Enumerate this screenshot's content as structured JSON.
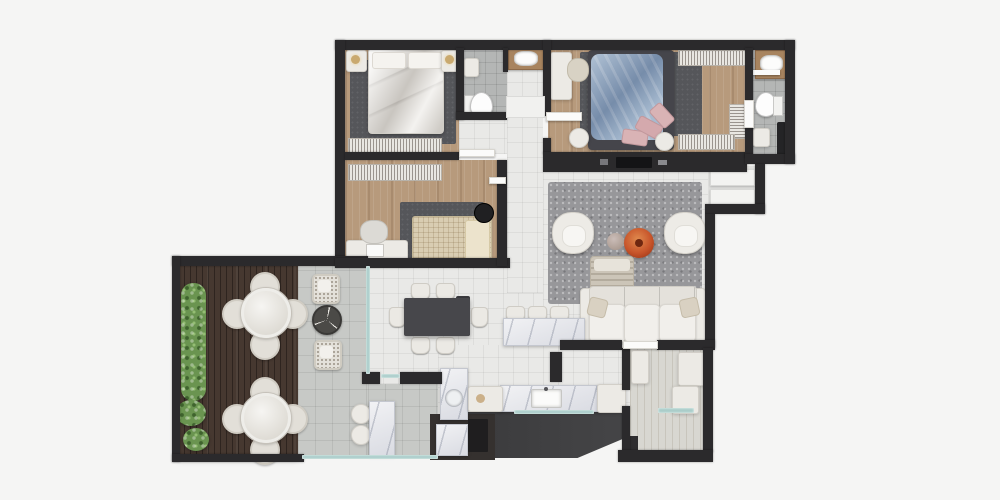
{
  "scene": {
    "type": "apartment-floor-plan-3d-render",
    "view": "top-down",
    "background": "#f5f5f4"
  },
  "palette": {
    "bg": "#f5f5f4",
    "wall": "#2b2a2c",
    "wood": "#b79a7c",
    "wood2": "#a8845f",
    "deck": "#463830",
    "tileLight": "#e9e9e7",
    "tileTerrace": "#c7c9c6",
    "tileBath": "#b4b6b5",
    "laundryFloor": "#d8d7d1",
    "rugLiving": "#97979a",
    "rugDark": "#55565a",
    "white": "#eceae5",
    "marble": "#e3e4e9",
    "glass": "#a9cdc9",
    "accentOrange": "#c85a32",
    "blue": "#8ea7c2",
    "pink": "#d9b3b5",
    "cream": "#d9cdb2",
    "green": "#6a9450",
    "darkFurn": "#47474b",
    "black": "#1c1c1e",
    "serviceFloor": "#454547"
  },
  "rooms": [
    "terrace-deck",
    "terrace-tiled",
    "bedroom-1",
    "bedroom-2",
    "bathroom",
    "hallway",
    "master-bedroom",
    "master-bathroom",
    "closet-nook",
    "living-room",
    "dining-area",
    "kitchen",
    "service-balcony",
    "laundry-room",
    "grill-nook"
  ],
  "furniture": {
    "terrace": [
      "planter-hedge",
      "shrub",
      "outdoor-dining-set-x2",
      "rattan-chair-pair",
      "round-side-table",
      "bistro-table",
      "bistro-chairs",
      "grill-counter"
    ],
    "bedroom_1": [
      "double-bed",
      "nightstand-left",
      "nightstand-right",
      "table-lamps",
      "area-rug",
      "wardrobe-rails"
    ],
    "bedroom_2": [
      "single-bed",
      "desk",
      "desk-chair",
      "laptop",
      "round-side-table",
      "area-rug",
      "wardrobe-rail"
    ],
    "bathroom": [
      "toilet",
      "wall-cabinet",
      "vanity-sink"
    ],
    "master_bedroom": [
      "double-bed-blue-duvet",
      "pink-pillows",
      "desk",
      "desk-chair",
      "pouf-left",
      "pouf-right",
      "closet-rails",
      "area-rug",
      "tv-console",
      "tv"
    ],
    "master_bathroom": [
      "vanity-sink",
      "towel-shelf",
      "toilet",
      "shower-bar",
      "shower-control"
    ],
    "living_room": [
      "sofa",
      "throw-pillows",
      "ottoman",
      "armchair-left",
      "armchair-right",
      "coffee-table-orange",
      "side-table-small",
      "shag-rug"
    ],
    "dining": [
      "dining-table",
      "dining-chairs-x6",
      "sideboard"
    ],
    "kitchen": [
      "island-counter",
      "bar-stools-x3",
      "counter-marble",
      "sink",
      "cabinet-left",
      "cabinet-right",
      "glass-railing"
    ],
    "laundry": [
      "washer",
      "tall-cabinet",
      "storage-box",
      "glass-shelf",
      "dark-cabinet"
    ],
    "closet_nook": [
      "shelf-upper",
      "shelf-lower"
    ]
  }
}
